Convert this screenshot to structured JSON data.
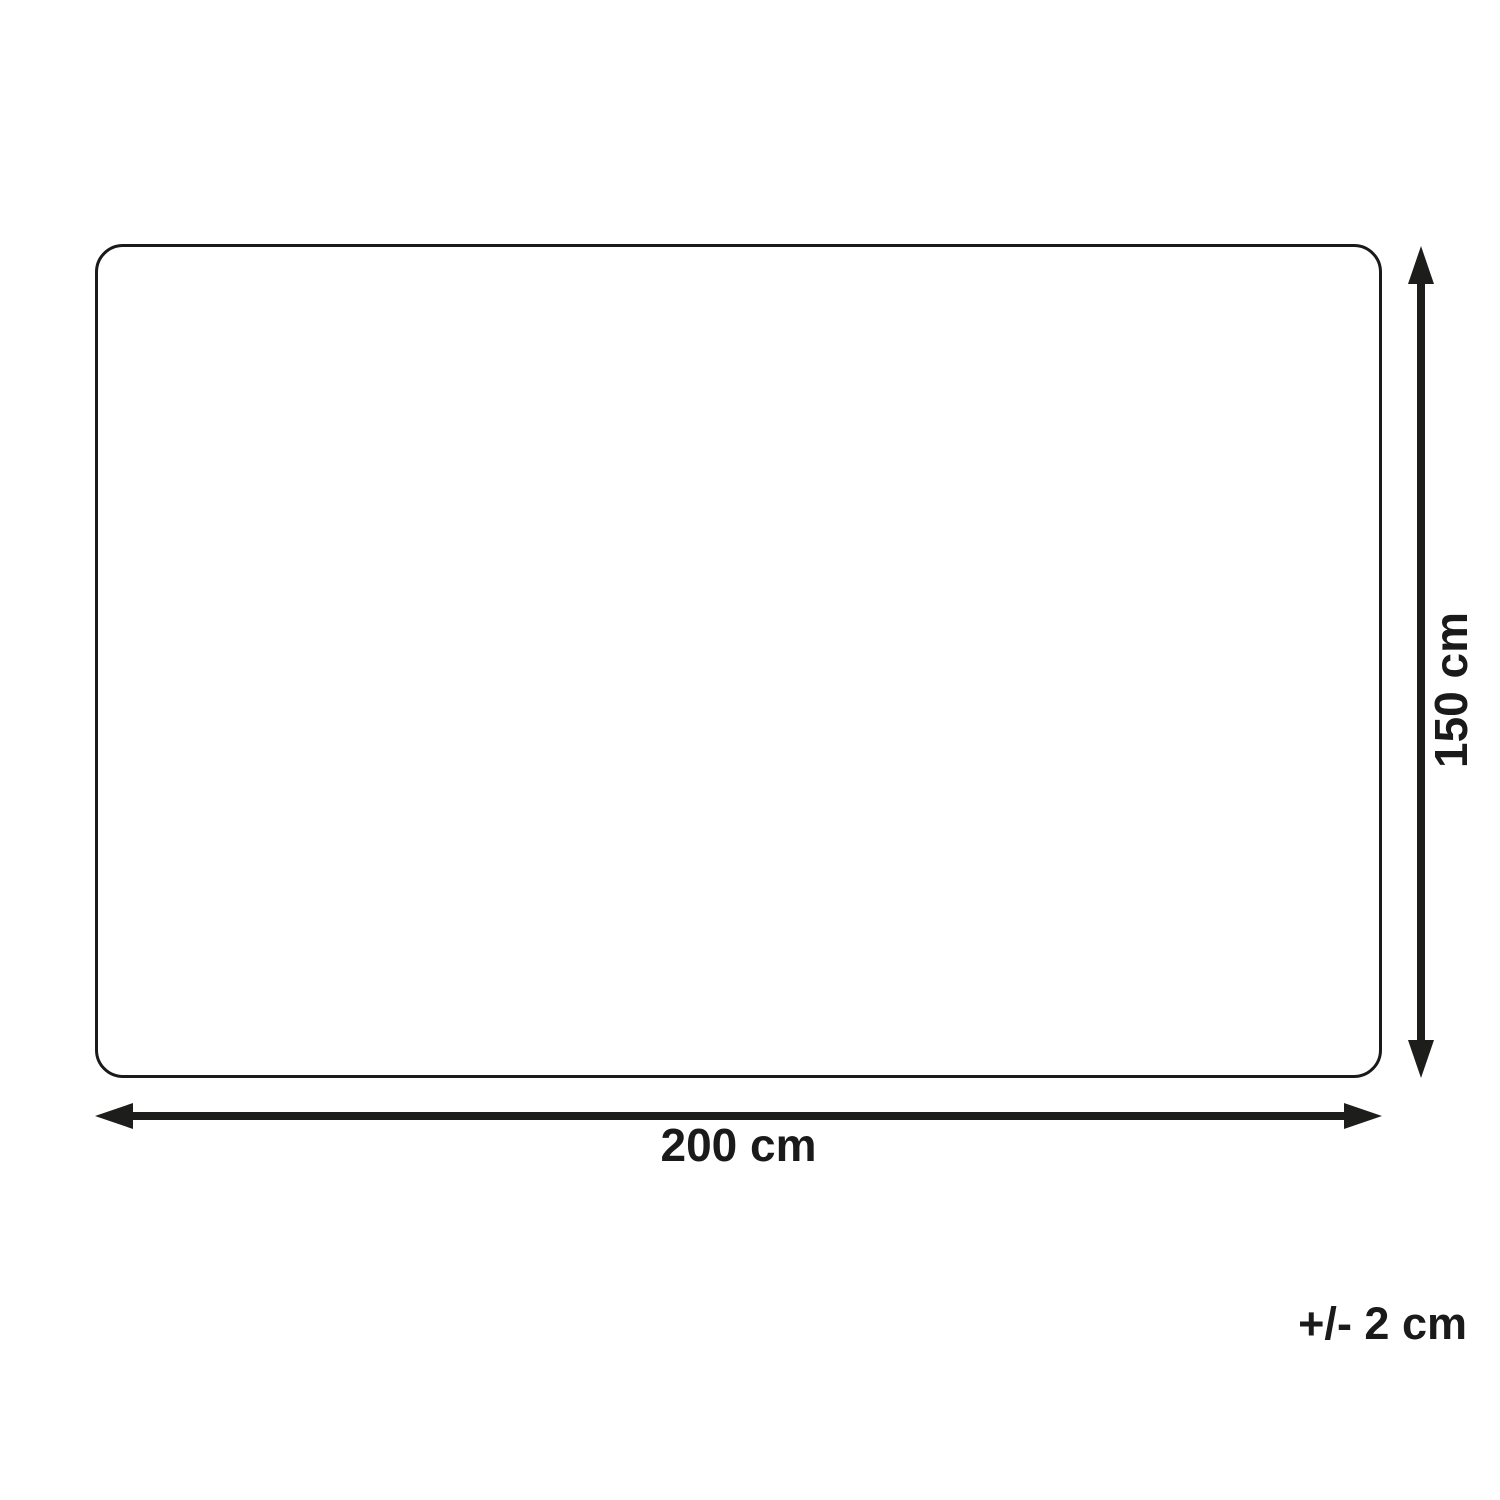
{
  "diagram": {
    "type": "product-dimension-diagram",
    "width_label": "200 cm",
    "height_label": "150 cm",
    "tolerance_label": "+/- 2 cm"
  },
  "colors": {
    "background": "#ffffff",
    "outline_stroke": "#1a1a1a",
    "arrow": "#1d1d1b",
    "text": "#1a1a1a"
  }
}
